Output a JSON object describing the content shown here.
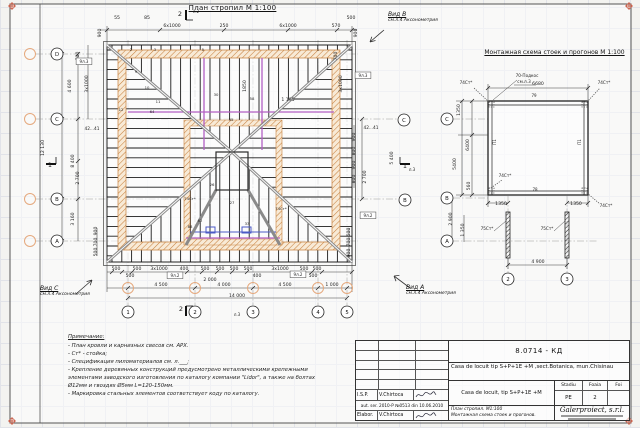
{
  "colors": {
    "line": "#1c1c1c",
    "dim": "#2a2a2a",
    "wall_orange": "#c8823f",
    "wall_fill": "#f8ead6",
    "purlin_magenta": "#b35fc4",
    "purlin_blue": "#4b5ac6",
    "axis_orange": "#e5a97e",
    "reg_mark": "#c44b33",
    "hip_gray": "#8a8a8a",
    "grid": "#e1e3e8",
    "paper": "#ffffff"
  },
  "titles": {
    "plan": "План стропил  М 1:100",
    "scheme": "Монтажная схема стоек и прогонов  М 1:100"
  },
  "views": {
    "b": {
      "label": "Вид B",
      "sub": "см.л.4 Аксонометрия"
    },
    "c": {
      "label": "Вид C",
      "sub": "см.л.4 Аксонометрия"
    },
    "a": {
      "label": "Вид A",
      "sub": "см.л.4 Аксонометрия"
    }
  },
  "notes": {
    "title": "Примечание:",
    "lines": [
      "- План кровли и карнизных свесов см. АРХ.",
      "- Ст* - стойка;",
      "- Спецификация пиломатериалов см. л.___;",
      "- Крепление деревянных конструкций предусмотрено металлическими крепежными элементами заводского изготовления по каталогу компании \"Lidor\", а также на болтах Ø12мм и гвоздях Ø5мм L=120-150мм.",
      "- Маркировка стальных элементов соответствует коду по каталогу."
    ]
  },
  "plan_axes": {
    "rows": [
      {
        "label": "D",
        "y": 54
      },
      {
        "label": "C",
        "y": 119
      },
      {
        "label": "B",
        "y": 199
      },
      {
        "label": "A",
        "y": 241
      }
    ],
    "cols": [
      {
        "label": "1",
        "x": 128
      },
      {
        "label": "2",
        "x": 195
      },
      {
        "label": "3",
        "x": 253
      },
      {
        "label": "4",
        "x": 318
      },
      {
        "label": "5",
        "x": 347
      }
    ],
    "right_rows": [
      {
        "label": "C",
        "x": 404,
        "y": 120
      },
      {
        "label": "B",
        "x": 405,
        "y": 200
      }
    ]
  },
  "scheme_axes": {
    "rows": [
      {
        "label": "C",
        "y": 119
      },
      {
        "label": "B",
        "y": 198
      },
      {
        "label": "A",
        "y": 241
      }
    ],
    "rows_x": 447,
    "cols": [
      {
        "label": "2",
        "x": 508
      },
      {
        "label": "3",
        "x": 567
      }
    ],
    "cols_y": 279
  },
  "plan_labels": [
    {
      "t": "900",
      "x": 101,
      "y": 33,
      "r": -90
    },
    {
      "t": "55",
      "x": 117,
      "y": 19
    },
    {
      "t": "85",
      "x": 147,
      "y": 19
    },
    {
      "t": "6x1000",
      "x": 172,
      "y": 27
    },
    {
      "t": "250",
      "x": 224,
      "y": 27
    },
    {
      "t": "6x1000",
      "x": 288,
      "y": 27
    },
    {
      "t": "570",
      "x": 336,
      "y": 27
    },
    {
      "t": "500",
      "x": 351,
      "y": 19
    },
    {
      "t": "900",
      "x": 357,
      "y": 33,
      "r": -90
    },
    {
      "t": "л.2",
      "x": 196,
      "y": 13,
      "s": 4
    },
    {
      "t": "2",
      "x": 180,
      "y": 16,
      "s": 6.5
    },
    {
      "t": "2",
      "x": 131,
      "y": 51,
      "s": 3.8
    },
    {
      "t": "3",
      "x": 155,
      "y": 51,
      "s": 3.8
    },
    {
      "t": "5",
      "x": 203,
      "y": 51,
      "s": 3.8
    },
    {
      "t": "1",
      "x": 318,
      "y": 51,
      "s": 3.8
    },
    {
      "t": "700",
      "x": 79,
      "y": 56,
      "r": -90
    },
    {
      "t": "3x1000",
      "x": 88,
      "y": 84,
      "r": -90
    },
    {
      "t": "4 600",
      "x": 71,
      "y": 86,
      "r": -90
    },
    {
      "t": "12 130",
      "x": 44,
      "y": 148,
      "r": -90
    },
    {
      "t": "8 400",
      "x": 74,
      "y": 161,
      "r": -90
    },
    {
      "t": "2 700",
      "x": 79,
      "y": 178,
      "r": -90
    },
    {
      "t": "3 160",
      "x": 74,
      "y": 219,
      "r": -90
    },
    {
      "t": "42...41",
      "x": 92,
      "y": 130,
      "s": 4.3
    },
    {
      "t": "900",
      "x": 97,
      "y": 231,
      "r": -90
    },
    {
      "t": "700",
      "x": 97,
      "y": 242,
      "r": -90
    },
    {
      "t": "500",
      "x": 97,
      "y": 252,
      "r": -90
    },
    {
      "t": "1",
      "x": 50,
      "y": 167,
      "s": 6.5
    },
    {
      "t": "700",
      "x": 337,
      "y": 56,
      "r": -90
    },
    {
      "t": "3x1000",
      "x": 342,
      "y": 84,
      "r": -90
    },
    {
      "t": "42...41",
      "x": 371,
      "y": 129,
      "s": 4.3
    },
    {
      "t": "900",
      "x": 355,
      "y": 137,
      "r": -90
    },
    {
      "t": "800",
      "x": 355,
      "y": 151,
      "r": -90
    },
    {
      "t": "900",
      "x": 355,
      "y": 165,
      "r": -90
    },
    {
      "t": "800",
      "x": 355,
      "y": 179,
      "r": -90
    },
    {
      "t": "5 400",
      "x": 393,
      "y": 158,
      "r": -90
    },
    {
      "t": "2 700",
      "x": 366,
      "y": 177,
      "r": -90
    },
    {
      "t": "500",
      "x": 350,
      "y": 232,
      "r": -90
    },
    {
      "t": "700",
      "x": 350,
      "y": 242,
      "r": -90
    },
    {
      "t": "900",
      "x": 350,
      "y": 253,
      "r": -90
    },
    {
      "t": "л.3",
      "x": 412,
      "y": 171,
      "s": 4
    },
    {
      "t": "1",
      "x": 405,
      "y": 168,
      "s": 6.5
    },
    {
      "t": "9л.2",
      "x": 368,
      "y": 217,
      "s": 4,
      "box": true
    },
    {
      "t": "500",
      "x": 116,
      "y": 270
    },
    {
      "t": "500",
      "x": 137,
      "y": 270
    },
    {
      "t": "3x1000",
      "x": 159,
      "y": 270
    },
    {
      "t": "400",
      "x": 184,
      "y": 270
    },
    {
      "t": "500",
      "x": 205,
      "y": 270
    },
    {
      "t": "500",
      "x": 220,
      "y": 270
    },
    {
      "t": "500",
      "x": 234,
      "y": 270
    },
    {
      "t": "500",
      "x": 248,
      "y": 270
    },
    {
      "t": "3x1000",
      "x": 280,
      "y": 270
    },
    {
      "t": "500",
      "x": 304,
      "y": 270
    },
    {
      "t": "500",
      "x": 317,
      "y": 270
    },
    {
      "t": "500",
      "x": 130,
      "y": 277
    },
    {
      "t": "2 000",
      "x": 210,
      "y": 281
    },
    {
      "t": "400",
      "x": 257,
      "y": 277
    },
    {
      "t": "500",
      "x": 313,
      "y": 277
    },
    {
      "t": "9л.2",
      "x": 175,
      "y": 277,
      "s": 4,
      "box": true
    },
    {
      "t": "9л.2",
      "x": 298,
      "y": 276,
      "s": 4,
      "box": true
    },
    {
      "t": "4 500",
      "x": 161,
      "y": 286
    },
    {
      "t": "4 000",
      "x": 224,
      "y": 286
    },
    {
      "t": "4 500",
      "x": 285,
      "y": 286
    },
    {
      "t": "1 000",
      "x": 332,
      "y": 286
    },
    {
      "t": "14 000",
      "x": 237,
      "y": 297
    },
    {
      "t": "л.3",
      "x": 237,
      "y": 316,
      "s": 4
    },
    {
      "t": "2",
      "x": 181,
      "y": 311,
      "s": 6.5
    },
    {
      "t": "9л.3",
      "x": 84,
      "y": 63,
      "s": 4,
      "box": true
    },
    {
      "t": "9л.3",
      "x": 363,
      "y": 77,
      "s": 4,
      "box": true
    },
    {
      "t": "9",
      "x": 136,
      "y": 73,
      "s": 3.8
    },
    {
      "t": "10",
      "x": 147,
      "y": 89,
      "s": 3.8
    },
    {
      "t": "11",
      "x": 158,
      "y": 103,
      "s": 3.8
    },
    {
      "t": "12",
      "x": 121,
      "y": 111,
      "s": 3.8
    },
    {
      "t": "64",
      "x": 152,
      "y": 113,
      "s": 3.8
    },
    {
      "t": "30",
      "x": 216,
      "y": 96,
      "s": 3.8
    },
    {
      "t": "58",
      "x": 252,
      "y": 100,
      "s": 3.8
    },
    {
      "t": "35",
      "x": 231,
      "y": 121,
      "s": 3.8
    },
    {
      "t": "26",
      "x": 212,
      "y": 186,
      "s": 3.8
    },
    {
      "t": "27",
      "x": 232,
      "y": 204,
      "s": 3.8
    },
    {
      "t": "33",
      "x": 247,
      "y": 225,
      "s": 3.8
    },
    {
      "t": "62",
      "x": 200,
      "y": 222,
      "s": 3.8
    },
    {
      "t": "88",
      "x": 190,
      "y": 228,
      "s": 3.8
    },
    {
      "t": "74Ст*",
      "x": 190,
      "y": 200,
      "s": 3.8
    },
    {
      "t": "74Ст*",
      "x": 281,
      "y": 210,
      "s": 3.8
    },
    {
      "t": "1850",
      "x": 246,
      "y": 86,
      "r": -90
    },
    {
      "t": "1 195",
      "x": 288,
      "y": 101
    }
  ],
  "scheme_labels": [
    {
      "t": "6680",
      "x": 538,
      "y": 85
    },
    {
      "t": "70-Подкос",
      "x": 527,
      "y": 77,
      "s": 4.2
    },
    {
      "t": "см.л.3",
      "x": 524,
      "y": 83,
      "s": 4.2
    },
    {
      "t": "74Ст*",
      "x": 466,
      "y": 84,
      "s": 4.2
    },
    {
      "t": "74Ст*",
      "x": 604,
      "y": 84,
      "s": 4.2
    },
    {
      "t": "74Ст*",
      "x": 505,
      "y": 177,
      "s": 4.2
    },
    {
      "t": "74Ст*",
      "x": 606,
      "y": 207,
      "s": 4.2
    },
    {
      "t": "79",
      "x": 534,
      "y": 97,
      "s": 4
    },
    {
      "t": "78",
      "x": 535,
      "y": 191,
      "s": 4
    },
    {
      "t": "П1",
      "x": 496,
      "y": 142,
      "r": -90,
      "s": 4
    },
    {
      "t": "П1",
      "x": 581,
      "y": 142,
      "r": -90,
      "s": 4
    },
    {
      "t": "1350",
      "x": 460,
      "y": 110,
      "r": -90
    },
    {
      "t": "6400",
      "x": 469,
      "y": 145,
      "r": -90
    },
    {
      "t": "5400",
      "x": 456,
      "y": 164,
      "r": -90
    },
    {
      "t": "560",
      "x": 470,
      "y": 186,
      "r": -90
    },
    {
      "t": "1350",
      "x": 501,
      "y": 205
    },
    {
      "t": "1350",
      "x": 576,
      "y": 205
    },
    {
      "t": "75Ст*",
      "x": 487,
      "y": 230,
      "s": 4.2
    },
    {
      "t": "75Ст*",
      "x": 547,
      "y": 230,
      "s": 4.2
    },
    {
      "t": "2 900",
      "x": 452,
      "y": 219,
      "r": -90
    },
    {
      "t": "1 350",
      "x": 464,
      "y": 230,
      "r": -90
    },
    {
      "t": "4 900",
      "x": 538,
      "y": 263
    }
  ],
  "titleblock": {
    "code": "8.0714 - КД",
    "object": "Casa de locuit tip  S+P+1E +M ,sect.Botanica, mun.Chisinau",
    "object2": "Casa de locuit, tip S+P+1E +M",
    "stadiu_label": "Stadiu",
    "foaia_label": "Foaia",
    "foi_label": "Foi",
    "stadiu": "PE",
    "foaia": "2",
    "foi": "",
    "sheet_title1": "План стропил.  М1:100",
    "sheet_title2": "Монтажная схема стоек и прогонов.",
    "company": "Galerproiect, s.r.l.",
    "isp_label": "I.S.P.",
    "isp_name": "V.Chirtoca",
    "license": "aut. ser. 2010-P №0513 din 10.06.2010",
    "elab_label": "Elabor.",
    "elab_name": "V.Chirtoca"
  }
}
